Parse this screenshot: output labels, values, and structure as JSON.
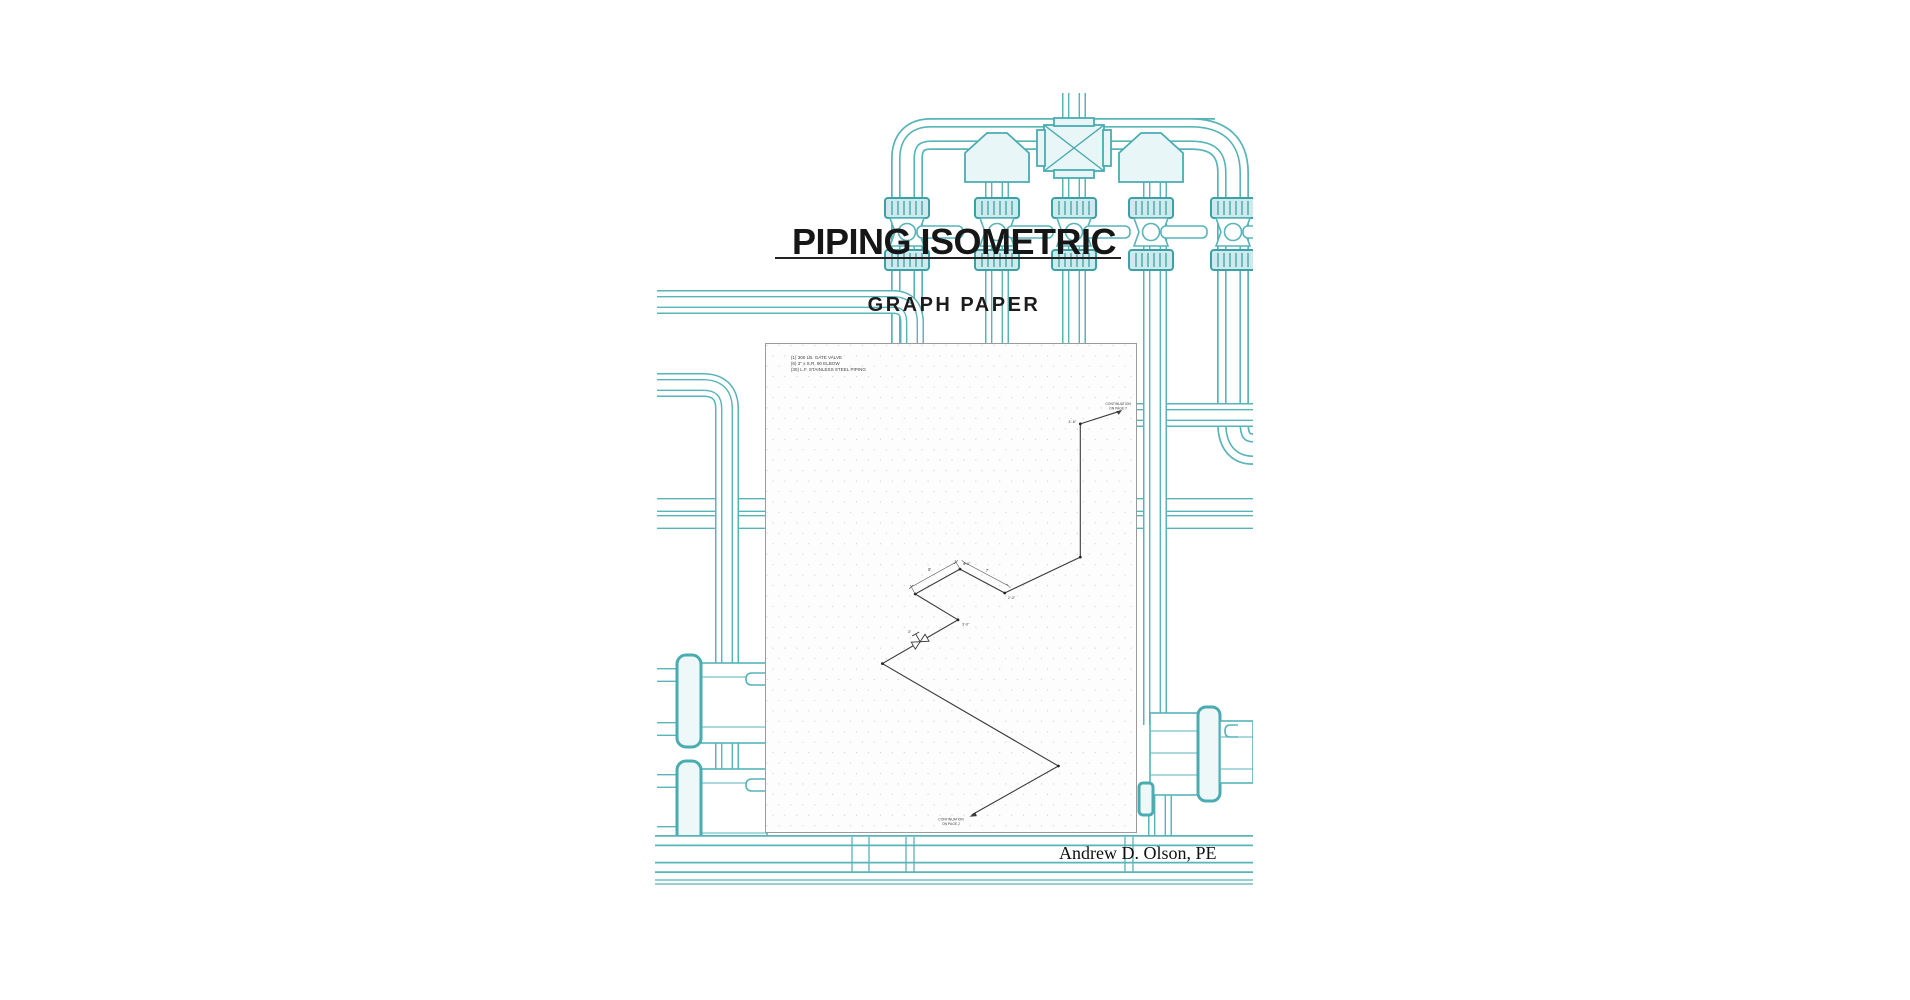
{
  "cover": {
    "title": "PIPING ISOMETRIC",
    "subtitle": "GRAPH PAPER",
    "author": "Andrew D. Olson, PE"
  },
  "sheet": {
    "bom": [
      "(1) 300 LB. GATE VALVE",
      "(6) 3\" x S.R. 90 ELBOW",
      "(30) L.F. STAINLESS STEEL PIPING"
    ],
    "continuation_top_1": "CONTINUATION",
    "continuation_top_2": "ON PAGE 7",
    "continuation_bottom_1": "CONTINUATION",
    "continuation_bottom_2": "ON PAGE 2",
    "labels": {
      "riser": "4'-6\"",
      "dim_a": "8'",
      "dim_b": "7'",
      "node_a": "4'-0\"",
      "node_b": "2'-0\"",
      "node_c": "3'-0\"",
      "valve_size": "3\""
    }
  },
  "colors": {
    "pipe_teal": "#57b4b8",
    "fitting_fill": "#e9f6f7",
    "coupling_fill": "#cfeaec",
    "ink": "#161616",
    "drawing_line": "#3a3a3a",
    "grid_dot": "#cccccc"
  }
}
